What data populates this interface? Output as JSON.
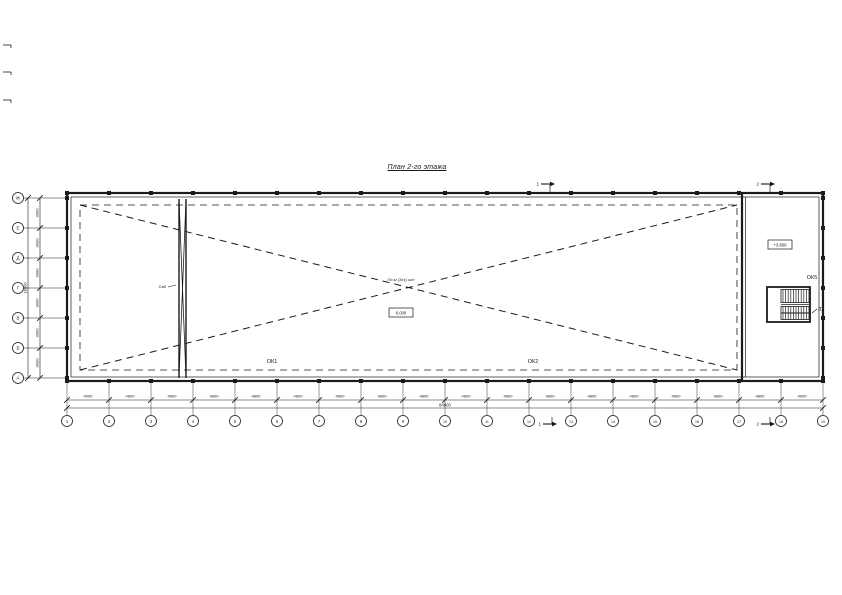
{
  "title": "План 2-го этажа",
  "colors": {
    "ink": "#1b1b1b",
    "paper": "#ffffff"
  },
  "grid": {
    "vertical_axes": [
      "1",
      "2",
      "3",
      "4",
      "5",
      "6",
      "7",
      "8",
      "9",
      "10",
      "11",
      "12",
      "13",
      "14",
      "15",
      "16",
      "17",
      "18",
      "19"
    ],
    "horizontal_axes": [
      "Ж",
      "Е",
      "Д",
      "Г",
      "В",
      "Б",
      "А"
    ],
    "bottom_bay_dims": [
      "4000",
      "4800",
      "4800",
      "4800",
      "4800",
      "4800",
      "4800",
      "4800",
      "4800",
      "4800",
      "4800",
      "4800",
      "4800",
      "4800",
      "4800",
      "4800",
      "4800",
      "4000"
    ],
    "bottom_total_dim": "84800",
    "left_bay_dims": [
      "3000",
      "3000",
      "3000",
      "3000",
      "3000",
      "3000"
    ],
    "left_total_dim": "18000"
  },
  "labels": {
    "window_left": "ОК1",
    "window_mid": "ОК2",
    "window_right": "ОК5",
    "stair": "Л2",
    "brace": "Св5",
    "center_note": "Пл-м (3х4) шт",
    "elevation_center": "6.000",
    "elevation_right": "+3.600",
    "section_left": "1",
    "section_right": "2"
  }
}
